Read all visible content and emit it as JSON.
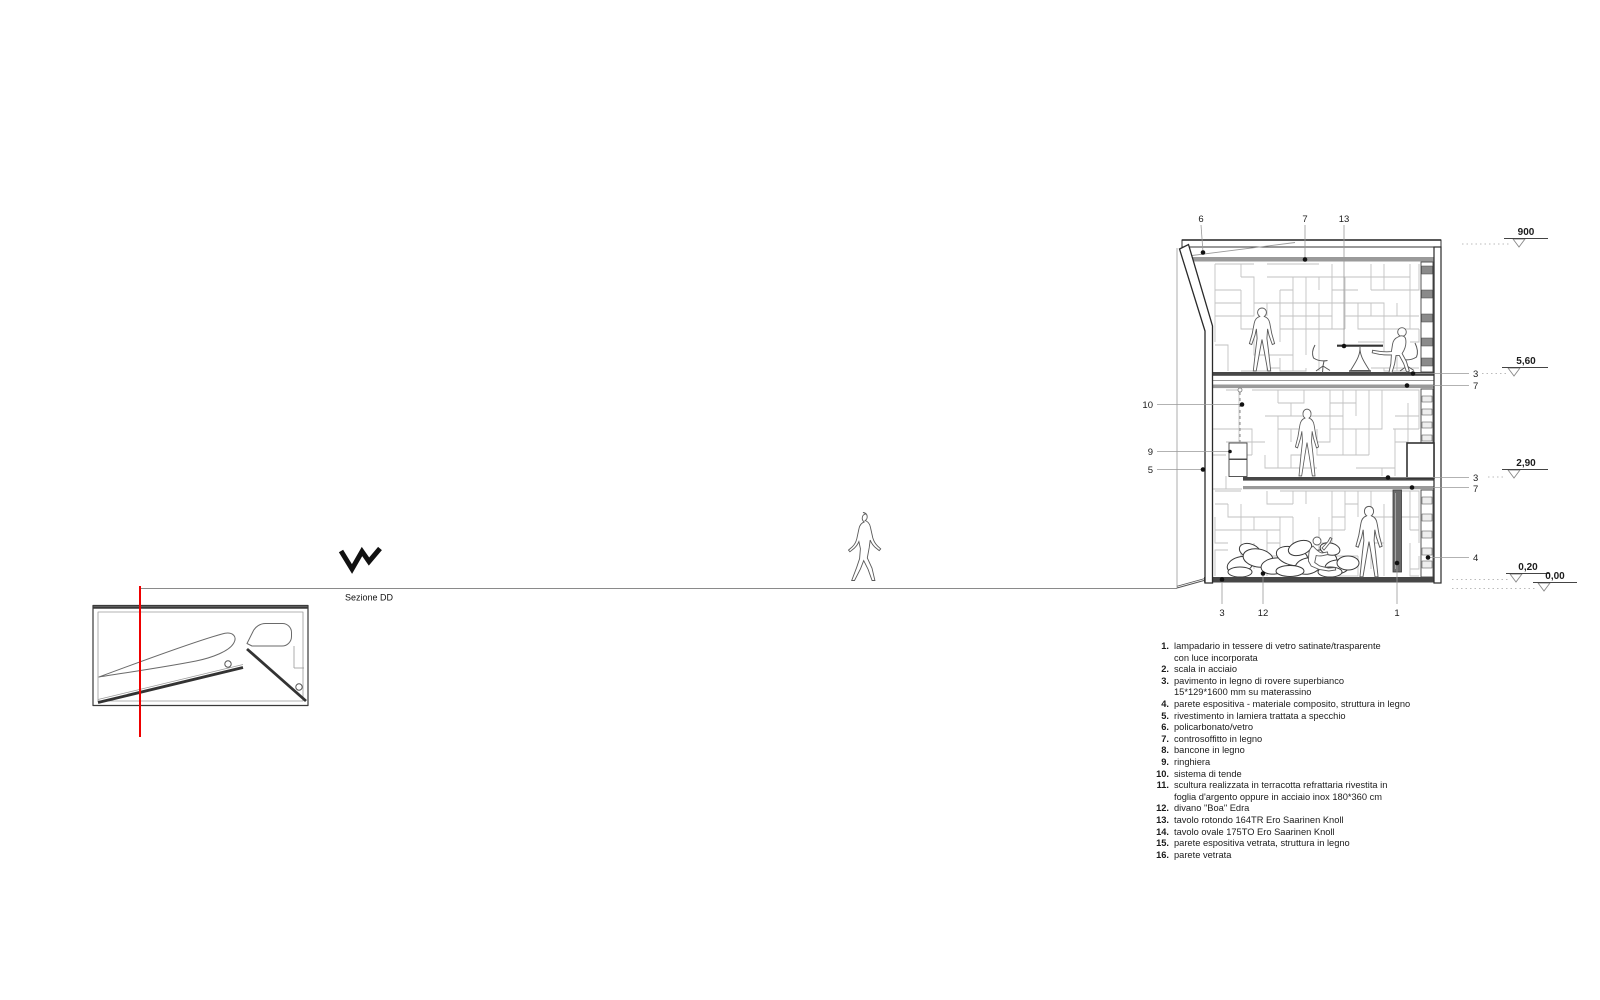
{
  "section": {
    "title": "Sezione DD"
  },
  "levels": [
    {
      "label": "900"
    },
    {
      "label": "5,60"
    },
    {
      "label": "2,90"
    },
    {
      "label": "0,20"
    },
    {
      "label": "0,00"
    }
  ],
  "callouts": {
    "top": [
      "6",
      "7",
      "13"
    ],
    "left": [
      "10",
      "9",
      "5"
    ],
    "bottom": [
      "3",
      "12",
      "1"
    ],
    "right": [
      "3",
      "7",
      "3",
      "7",
      "4"
    ]
  },
  "legend": {
    "items": [
      {
        "n": "1.",
        "t": "lampadario in tessere di vetro satinate/trasparente\ncon luce incorporata"
      },
      {
        "n": "2.",
        "t": "scala in acciaio"
      },
      {
        "n": "3.",
        "t": "pavimento in legno di rovere superbianco\n15*129*1600 mm su materassino"
      },
      {
        "n": "4.",
        "t": "parete espositiva - materiale composito, struttura in legno"
      },
      {
        "n": "5.",
        "t": "rivestimento in lamiera trattata a specchio"
      },
      {
        "n": "6.",
        "t": "policarbonato/vetro"
      },
      {
        "n": "7.",
        "t": "controsoffitto in legno"
      },
      {
        "n": "8.",
        "t": "bancone in legno"
      },
      {
        "n": "9.",
        "t": "ringhiera"
      },
      {
        "n": "10.",
        "t": "sistema di tende"
      },
      {
        "n": "11.",
        "t": "scultura realizzata in terracotta refrattaria rivestita in\nfoglia d'argento oppure in acciaio inox 180*360 cm"
      },
      {
        "n": "12.",
        "t": "divano \"Boa\" Edra"
      },
      {
        "n": "13.",
        "t": "tavolo rotondo 164TR Ero Saarinen Knoll"
      },
      {
        "n": "14.",
        "t": "tavolo ovale 175TO Ero Saarinen Knoll"
      },
      {
        "n": "15.",
        "t": "parete espositiva vetrata, struttura in legno"
      },
      {
        "n": "16.",
        "t": "parete vetrata"
      }
    ]
  },
  "colors": {
    "cut_line": "#ee0000",
    "line": "#222222",
    "leader": "#999999",
    "wall_pattern": "#c2c2c2",
    "slab": "#474747",
    "ceiling": "#9a9a9a",
    "chandelier": "#6a6a6a"
  }
}
